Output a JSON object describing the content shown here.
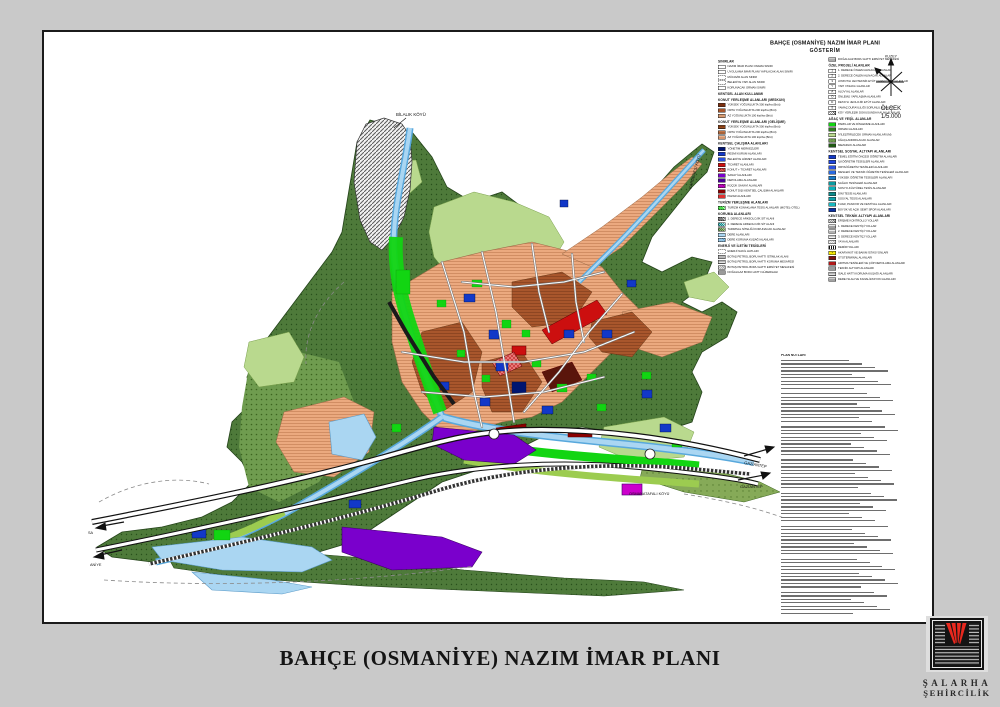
{
  "footer_title": "BAHÇE (OSMANİYE) NAZIM İMAR PLANI",
  "legend": {
    "title": "BAHÇE (OSMANİYE) NAZIM İMAR PLANI",
    "subtitle": "GÖSTERİM",
    "columns": [
      [
        {
          "header": "SINIRLAR",
          "items": [
            {
              "l": "NAZIM İMAR PLANI ONAMA SINIRI",
              "s": {
                "bg": "#ffffff"
              }
            },
            {
              "l": "UYGULAMA İMAR PLANI YAPILACAK ALAN SINIRI",
              "s": {
                "bg": "#ffffff"
              }
            },
            {
              "l": "MÜCAVİR ALAN SINIRI",
              "s": {
                "bg": "#ffffff",
                "fx": "da"
              }
            },
            {
              "l": "BELEDİYE YAPI ALAN SINIRI",
              "s": {
                "bg": "#ffffff",
                "fx": "da"
              }
            },
            {
              "l": "KORUNACAK ORMAN SINIRI",
              "s": {
                "bg": "#ffffff"
              }
            }
          ]
        },
        {
          "header": "KENTSEL ALAN KULLANIMI",
          "items": []
        },
        {
          "header": "KONUT YERLEŞME ALANLARI (MESKUN)",
          "items": [
            {
              "l": "YÜKSEK YOĞUNLUKTA 300 kişi/ha (Brüt)",
              "s": {
                "bg": "#7a2f0e"
              }
            },
            {
              "l": "ORTA YOĞUNLUKTA 200 kişi/ha (Brüt)",
              "s": {
                "bg": "#a8562c"
              }
            },
            {
              "l": "AZ YOĞUNLUKTA 100 kişi/ha (Brüt)",
              "s": {
                "bg": "#d79b72"
              }
            }
          ]
        },
        {
          "header": "KONUT YERLEŞME ALANLARI (GELİŞME)",
          "items": [
            {
              "l": "YÜKSEK YOĞUNLUKTA 300 kişi/ha (Brüt)",
              "s": {
                "bg": "#9a4a1a",
                "fx": "hl",
                "ln": "#6b2f0c"
              }
            },
            {
              "l": "ORTA YOĞUNLUKTA 200 kişi/ha (Brüt)",
              "s": {
                "bg": "#c4784a",
                "fx": "hl",
                "ln": "#8f4e26"
              }
            },
            {
              "l": "AZ YOĞUNLUKTA 100 kişi/ha (Brüt)",
              "s": {
                "bg": "#ecb28c",
                "fx": "hl",
                "ln": "#c07a50"
              }
            }
          ]
        },
        {
          "header": "KENTSEL ÇALIŞMA ALANLARI",
          "items": [
            {
              "l": "YÖNETİM MERKEZLERİ",
              "s": {
                "bg": "#001570"
              }
            },
            {
              "l": "RESMİ KURUM ALANLARI",
              "s": {
                "bg": "#1238c8"
              }
            },
            {
              "l": "BELEDİYE HİZMET ALANLARI",
              "s": {
                "bg": "#2a52e0"
              }
            },
            {
              "l": "TİCARET ALANLARI",
              "s": {
                "bg": "#cc0f0f"
              }
            },
            {
              "l": "KONUT + TİCARET ALANLARI",
              "s": {
                "bg": "#e87878",
                "fx": "cr",
                "ln": "#b01010"
              }
            },
            {
              "l": "SANAYİ ALANLARI",
              "s": {
                "bg": "#7a00cc"
              }
            },
            {
              "l": "DEPOLAMA ALANLARI",
              "s": {
                "bg": "#4b0096"
              }
            },
            {
              "l": "KÜÇÜK SANAYİ ALANLARI",
              "s": {
                "bg": "#cc00cc",
                "fx": "dg",
                "ln": "#8a008a"
              }
            },
            {
              "l": "KONUT DIŞI KENTSEL ÇALIŞMA ALANLARI",
              "s": {
                "bg": "#8b0000"
              }
            },
            {
              "l": "PAZAR ALANLARI",
              "s": {
                "bg": "#e03030"
              }
            }
          ]
        },
        {
          "header": "TURİZM YERLEŞME ALANLARI",
          "items": [
            {
              "l": "TURİZM KONAKLAMA TESİS ALANLARI (MOTEL-OTEL)",
              "s": {
                "bg": "#12d512",
                "fx": "dg",
                "ln": "#ffffff"
              }
            }
          ]
        },
        {
          "header": "KORUMA ALANLARI",
          "items": [
            {
              "l": "1. DERECE ARKEOLOJİK SİT ALANI",
              "s": {
                "bg": "#555555",
                "fx": "dg",
                "ln": "#ffffff"
              }
            },
            {
              "l": "2. DERECE ARKEOLOJİK SİT ALANI",
              "s": {
                "bg": "#0a8a8a",
                "fx": "dg",
                "ln": "#ffffff"
              }
            },
            {
              "l": "TARIMSAL NİTELİĞİ KORUNACAK ALANLAR",
              "s": {
                "bg": "#4e7a3a",
                "fx": "dg",
                "ln": "#cfe6b8"
              }
            },
            {
              "l": "DERE ALANLARI",
              "s": {
                "bg": "#aad6f2"
              }
            },
            {
              "l": "DERE KORUMA KUŞAĞI ALANLARI",
              "s": {
                "bg": "#aad6f2",
                "fx": "dg",
                "ln": "#4a8ec0"
              }
            }
          ]
        },
        {
          "header": "ENERJİ VE İLETİM TESİSLERİ",
          "items": [
            {
              "l": "ENERJİ NAKİL HATLARI",
              "s": {
                "bg": "#ffffff",
                "fx": "da"
              }
            },
            {
              "l": "BOTAŞ PETROL BORU HATTI İSTİMLAK ALANI",
              "s": {
                "bg": "#b8b8b8"
              }
            },
            {
              "l": "BOTAŞ PETROL BORU HATTI KORUMA MESAFESİ",
              "s": {
                "bg": "#e2e2e2",
                "fx": "hl",
                "ln": "#8a8a8a"
              }
            },
            {
              "l": "BOTAŞ PETROL BORU HATTI EMNİYET MESAFESİ",
              "s": {
                "bg": "#e2e2e2",
                "fx": "dg",
                "ln": "#8a8a8a"
              }
            },
            {
              "l": "DOĞALGAZ BORU HATTI GÜZERGAHI",
              "s": {
                "bg": "#9a9a9a"
              }
            }
          ]
        }
      ],
      [
        {
          "header": "",
          "items": [
            {
              "l": "DOĞALGAZ BORU HATTI EMNİYET MESAFESİ",
              "s": {
                "bg": "#cccccc",
                "fx": "hl",
                "ln": "#8a8a8a"
              }
            }
          ]
        },
        {
          "header": "ÖZEL PROJELİ ALANLAR",
          "items": [
            {
              "l": "1. DERECE ÖNLEM ALINACAK ALANLAR",
              "s": {
                "bg": "#ffffff",
                "t": "1"
              }
            },
            {
              "l": "2. DERECE ÖNLEM ALINACAK ALANLAR",
              "s": {
                "bg": "#ffffff",
                "t": "2"
              }
            },
            {
              "l": "AYRINTILI JEOTEKNİK ETÜT GEREKTİREN ALANLAR",
              "s": {
                "bg": "#ffffff",
                "t": "3"
              }
            },
            {
              "l": "YAPI YASAKLI ALANLAR",
              "s": {
                "bg": "#ffffff",
                "t": "Y"
              }
            },
            {
              "l": "ALÜVYAL ALANLAR",
              "s": {
                "bg": "#ffffff",
                "t": "A"
              }
            },
            {
              "l": "ÖNLEMLİ YAPILAŞMA ALANLARI",
              "s": {
                "bg": "#ffffff",
                "t": "Ö"
              }
            },
            {
              "l": "DETAYLI JEOLOJİK ETÜT ALANLARI",
              "s": {
                "bg": "#ffffff",
                "t": "D"
              }
            },
            {
              "l": "YAMAÇ DURAYLILIĞI SORUNLU ALANLAR",
              "s": {
                "bg": "#ffffff",
                "t": "S"
              }
            },
            {
              "l": "KÖY YERLEŞİK DOKUSUNDA KALAN ALANLAR",
              "s": {
                "bg": "#ffffff",
                "fx": "dg",
                "ln": "#333333"
              }
            }
          ]
        },
        {
          "header": "AĞAÇ VE YEŞİL ALANLAR",
          "items": [
            {
              "l": "PARKLAR VE DİNLENME ALANLARI",
              "s": {
                "bg": "#12d512"
              }
            },
            {
              "l": "ORMAN ALANLARI",
              "s": {
                "bg": "#2f7a1f"
              }
            },
            {
              "l": "İYİLEŞTİRİLECEK ORMAN ALANLARI (M)",
              "s": {
                "bg": "#b9d98e"
              }
            },
            {
              "l": "AĞAÇLANDIRILACAK ALANLAR",
              "s": {
                "bg": "#6f9c4f",
                "fx": "dt",
                "ln": "#2c501c"
              }
            },
            {
              "l": "MEZARLIK ALANLARI",
              "s": {
                "bg": "#1f5a14"
              }
            }
          ]
        },
        {
          "header": "KENTSEL SOSYAL ALTYAPI ALANLARI",
          "items": [
            {
              "l": "TEMEL EĞİTİM ÖNCESİ ÖĞRETİM ALANLARI",
              "s": {
                "bg": "#1238c8"
              }
            },
            {
              "l": "İLKÖĞRETİM TESİSLERİ ALANLARI",
              "s": {
                "bg": "#1e46dc"
              }
            },
            {
              "l": "ORTAÖĞRETİM TESİSLERİ ALANLARI",
              "s": {
                "bg": "#2a52e0"
              }
            },
            {
              "l": "MESLEKİ VE TEKNİK ÖĞRETİM TESİSLERİ ALANLARI",
              "s": {
                "bg": "#2a6ae0"
              }
            },
            {
              "l": "YÜKSEK ÖĞRETİM TESİSLERİ ALANLARI",
              "s": {
                "bg": "#1a7ac8"
              }
            },
            {
              "l": "SAĞLIK TESİSLERİ ALANLARI",
              "s": {
                "bg": "#0a9aa0"
              }
            },
            {
              "l": "SOSYO-KÜLTÜREL TESİS ALANLARI",
              "s": {
                "bg": "#0ab0b8"
              }
            },
            {
              "l": "DİNİ TESİS ALANLARI",
              "s": {
                "bg": "#0a8a8a"
              }
            },
            {
              "l": "SOSYAL TESİS ALANLARI",
              "s": {
                "bg": "#10a0a8"
              }
            },
            {
              "l": "FUAR, PANAYIR VE FESTİVAL ALANLARI",
              "s": {
                "bg": "#18b8c0"
              }
            },
            {
              "l": "BÜYÜK VE AÇIK SEMT SPOR ALANLARI",
              "s": {
                "bg": "#0a30a0"
              }
            }
          ]
        },
        {
          "header": "KENTSEL TEKNİK ALTYAPI ALANLARI",
          "items": [
            {
              "l": "ERİŞME KONTROLLÜ YOLLAR",
              "s": {
                "bg": "#dddddd",
                "fx": "dg",
                "ln": "#555555"
              }
            },
            {
              "l": "1. DERECE KENTİÇİ YOLLAR",
              "s": {
                "bg": "#e6e6e6",
                "fx": "hl",
                "ln": "#555555"
              }
            },
            {
              "l": "2. DERECE KENTİÇİ YOLLAR",
              "s": {
                "bg": "#ededed",
                "fx": "hl",
                "ln": "#777777"
              }
            },
            {
              "l": "3. DERECE KENTİÇİ YOLLAR",
              "s": {
                "bg": "#f3f3f3",
                "fx": "hl",
                "ln": "#999999"
              }
            },
            {
              "l": "YAYA ALANLARI",
              "s": {
                "bg": "#f5f5f5",
                "fx": "dg",
                "ln": "#aaaaaa"
              }
            },
            {
              "l": "DEMİRYOLLARI",
              "s": {
                "bg": "#ffffff",
                "fx": "rail"
              }
            },
            {
              "l": "AKARYAKIT VE BAKIM İSTASYONLARI",
              "s": {
                "bg": "#f5e800",
                "t": "•"
              }
            },
            {
              "l": "OTOTERMİNAL ALANLARI",
              "s": {
                "bg": "#7a1010"
              }
            },
            {
              "l": "ARITMA TESİSLERİ VE ÇÖP DEPOLAMA ALANLARI",
              "s": {
                "bg": "#b01818"
              }
            },
            {
              "l": "TEKNİK ALTYAPI ALANLARI",
              "s": {
                "bg": "#9a9a9a"
              }
            },
            {
              "l": "İSALE HATTI KORUMA KUŞAĞI ALANLARI",
              "s": {
                "bg": "#dddddd",
                "fx": "hl",
                "ln": "#8a8a8a"
              }
            },
            {
              "l": "DERE ISLAH VE KANALİZASYON ALANLARI",
              "s": {
                "bg": "#cccccc",
                "fx": "hl",
                "ln": "#777777"
              }
            }
          ]
        }
      ]
    ]
  },
  "compass": {
    "north_label": "KUZEY",
    "scale_label": "ÖLÇEK",
    "scale_value": "1/5.000"
  },
  "map_labels": {
    "bilalik": "BİLALIK KÖYÜ",
    "karderesi": "KARDERESİ KÖYÜ",
    "osmanatafali": "OSMANATAFALI KÖYÜ",
    "gaziantep_upper": "GAZİANTEP",
    "gaziantep_lower": "GAZİANTEP",
    "left_upper": "SA",
    "left_lower": "ANİYE"
  },
  "notes": {
    "title": "PLAN NOTLARI",
    "line_count": 70
  },
  "logo": {
    "name_line1": "ŞALARHA",
    "name_line2": "ŞEHİRCİLİK"
  },
  "colors": {
    "forest_green": "#4e7a3a",
    "light_green": "#b9d98e",
    "park_green": "#12d512",
    "residential_salmon": "#eba97f",
    "residential_brown": "#a8562c",
    "commerce_red": "#cc0f0f",
    "institution_blue": "#1238c8",
    "industry_purple": "#7a00cc",
    "small_industry_magenta": "#cc00cc",
    "water_blue": "#aad6f2",
    "dark_maroon": "#5a150b"
  }
}
